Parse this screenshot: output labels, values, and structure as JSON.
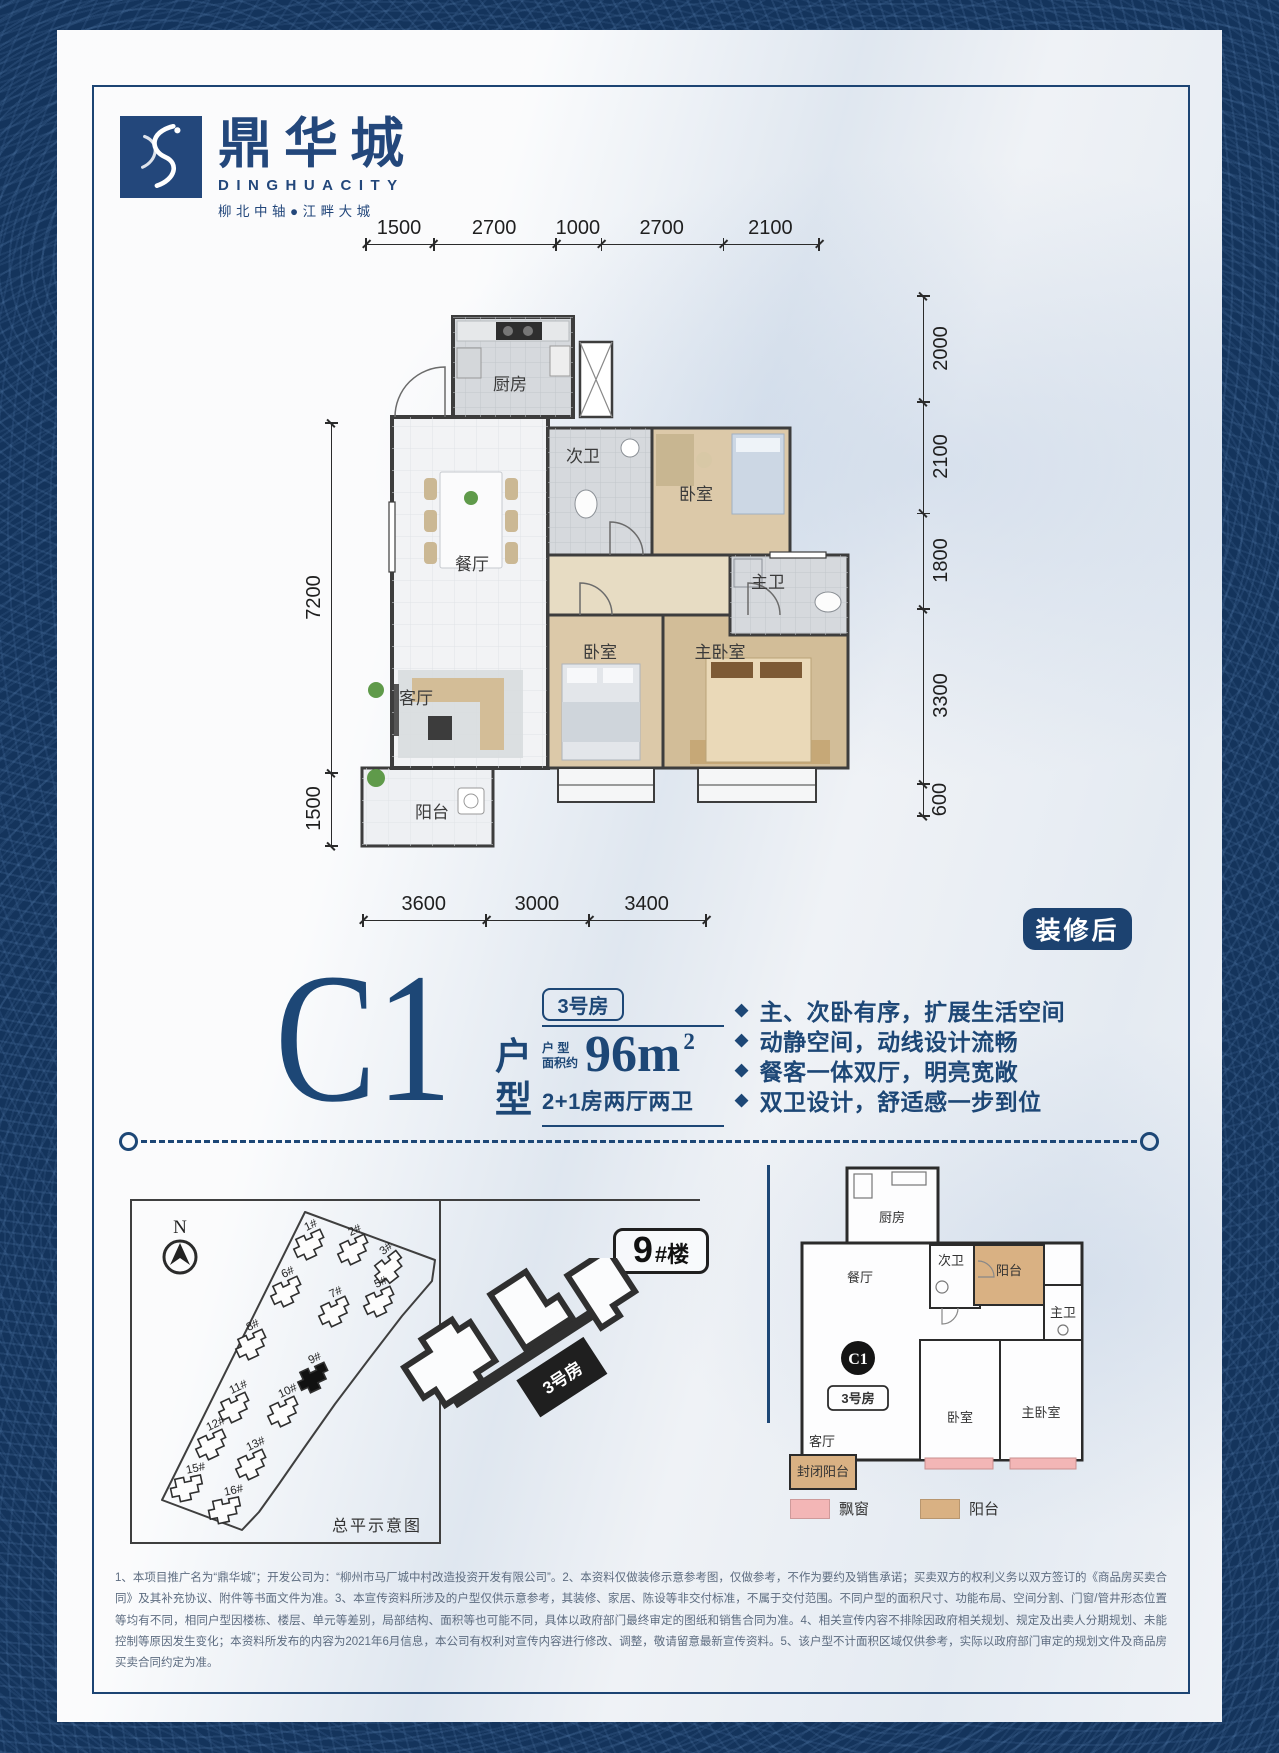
{
  "brand": {
    "logo_cn": "鼎华城",
    "logo_en": "DINGHUACITY",
    "slogan": "柳北中轴●江畔大城"
  },
  "colors": {
    "navy": "#1d4776",
    "badge_navy": "#1c4270",
    "pattern_blue": "#14345c",
    "bay_window_pink": "#f3b6b6",
    "balcony_tan": "#d9b183"
  },
  "floorplan": {
    "badge": "装修后",
    "dims": {
      "top": [
        1500,
        2700,
        1000,
        2700,
        2100
      ],
      "right": [
        2000,
        2100,
        1800,
        3300,
        600
      ],
      "bottom": [
        3600,
        3000,
        3400
      ],
      "left": [
        7200,
        1500
      ]
    },
    "rooms": {
      "kitchen": "厨房",
      "bath2": "次卫",
      "bed2": "卧室",
      "bath1": "主卫",
      "dining": "餐厅",
      "living": "客厅",
      "bed1": "卧室",
      "master": "主卧室",
      "balcony": "阳台"
    }
  },
  "unit": {
    "code": "C1",
    "type_label": "户型",
    "room_badge": "3号房",
    "area_prefix_line1": "户 型",
    "area_prefix_line2": "面积约",
    "area_value": "96m",
    "area_sup": "2",
    "layout": "2+1房两厅两卫",
    "bullet_icon": "◆",
    "features": [
      "主、次卧有序，扩展生活空间",
      "动静空间，动线设计流畅",
      "餐客一体双厅，明亮宽敞",
      "双卫设计，舒适感一步到位"
    ]
  },
  "siteplan": {
    "north": "N",
    "caption": "总平示意图",
    "building_label_big": "9",
    "building_label_small": "#楼",
    "unit_label": "3号房",
    "buildings": [
      {
        "label": "1#",
        "x": 178,
        "y": 45,
        "rot": -25,
        "filled": false
      },
      {
        "label": "2#",
        "x": 222,
        "y": 50,
        "rot": -25,
        "filled": false
      },
      {
        "label": "3#",
        "x": 258,
        "y": 68,
        "rot": -38,
        "filled": false
      },
      {
        "label": "6#",
        "x": 155,
        "y": 92,
        "rot": -25,
        "filled": false
      },
      {
        "label": "7#",
        "x": 203,
        "y": 112,
        "rot": -25,
        "filled": false
      },
      {
        "label": "5#",
        "x": 248,
        "y": 102,
        "rot": -25,
        "filled": false
      },
      {
        "label": "8#",
        "x": 120,
        "y": 145,
        "rot": -25,
        "filled": false
      },
      {
        "label": "9#",
        "x": 182,
        "y": 178,
        "rot": -25,
        "filled": true
      },
      {
        "label": "11#",
        "x": 103,
        "y": 208,
        "rot": -25,
        "filled": false
      },
      {
        "label": "10#",
        "x": 152,
        "y": 212,
        "rot": -25,
        "filled": false
      },
      {
        "label": "12#",
        "x": 80,
        "y": 245,
        "rot": -25,
        "filled": false
      },
      {
        "label": "13#",
        "x": 120,
        "y": 265,
        "rot": -25,
        "filled": false
      },
      {
        "label": "15#",
        "x": 55,
        "y": 288,
        "rot": -12,
        "filled": false
      },
      {
        "label": "16#",
        "x": 93,
        "y": 310,
        "rot": -12,
        "filled": false
      }
    ]
  },
  "miniplan": {
    "badge": "C1",
    "room_badge": "3号房",
    "rooms": {
      "kitchen": "厨房",
      "dining": "餐厅",
      "bath2": "次卫",
      "balcony": "阳台",
      "bath1": "主卫",
      "bed": "卧室",
      "master": "主卧室",
      "living": "客厅",
      "closed_balcony": "封闭阳台"
    },
    "legend": [
      {
        "label": "飘窗",
        "color": "#f3b6b6"
      },
      {
        "label": "阳台",
        "color": "#d9b183"
      }
    ]
  },
  "footer": {
    "disclaimer": "1、本项目推广名为“鼎华城”；开发公司为：“柳州市马厂城中村改造投资开发有限公司”。2、本资料仅做装修示意参考图，仅做参考，不作为要约及销售承诺；买卖双方的权利义务以双方签订的《商品房买卖合同》及其补充协议、附件等书面文件为准。3、本宣传资料所涉及的户型仅供示意参考，其装修、家居、陈设等非交付标准，不属于交付范围。不同户型的面积尺寸、功能布局、空间分割、门窗/管井形态位置等均有不同，相同户型因楼栋、楼层、单元等差别，局部结构、面积等也可能不同，具体以政府部门最终审定的图纸和销售合同为准。4、相关宣传内容不排除因政府相关规划、规定及出卖人分期规划、未能控制等原因发生变化；本资料所发布的内容为2021年6月信息，本公司有权利对宣传内容进行修改、调整，敬请留意最新宣传资料。5、该户型不计面积区域仅供参考，实际以政府部门审定的规划文件及商品房买卖合同约定为准。"
  }
}
